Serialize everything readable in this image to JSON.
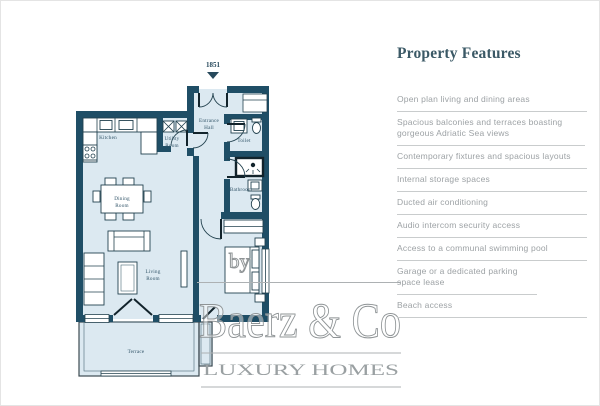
{
  "colors": {
    "wall": "#1f4e66",
    "floor": "#dce9f1",
    "title": "#3b5966",
    "text_muted": "#9da2a5",
    "divider": "#c9cccd",
    "watermark": "#9aa0a2"
  },
  "floorplan": {
    "unit_label": "1851",
    "rooms": {
      "kitchen": "Kitchen",
      "dining_l1": "Dining",
      "dining_l2": "Room",
      "living_l1": "Living",
      "living_l2": "Room",
      "utility_l1": "Utility",
      "utility_l2": "Room",
      "entrance_l1": "Entrance",
      "entrance_l2": "Hall",
      "toilet": "Toilet",
      "bathroom": "Bathroom",
      "terrace": "Terrace"
    }
  },
  "watermark": {
    "prefix": "by",
    "brand": "Baerz & Co",
    "tagline": "LUXURY HOMES"
  },
  "features": {
    "title": "Property Features",
    "items": [
      "Open plan living and dining areas",
      "Spacious balconies and terraces boasting gorgeous Adriatic Sea views",
      "Contemporary fixtures and spacious layouts",
      "Internal storage spaces",
      "Ducted air conditioning",
      "Audio intercom security access",
      "Access to a communal swimming pool",
      "Garage or a dedicated parking space lease",
      "Beach access"
    ]
  }
}
